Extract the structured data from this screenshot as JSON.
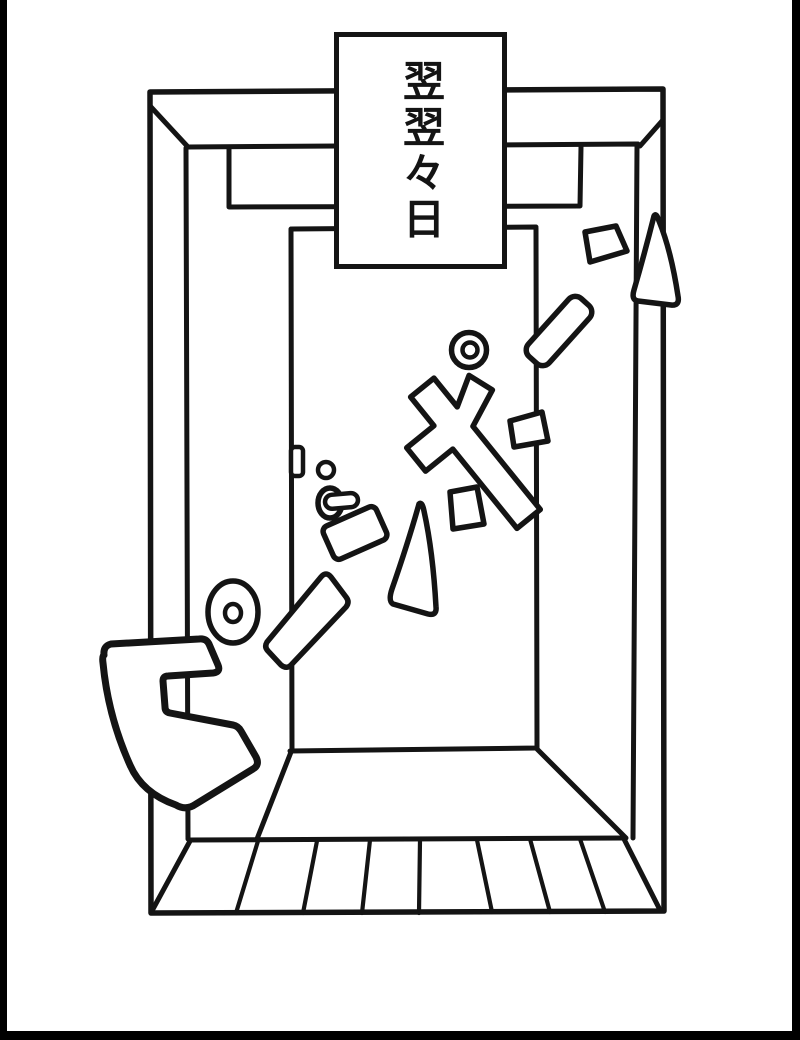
{
  "colors": {
    "ink": "#141414",
    "paper": "#ffffff",
    "panel_border": "#000000"
  },
  "caption": {
    "text": "翌翌々日"
  },
  "scene": {
    "kind": "manga-panel-drawing",
    "subject": "front-door-entryway-in-perspective",
    "sound_effect": {
      "visible_glyphs": [
        "ピ",
        "ポ"
      ],
      "style": "katakana-pieces-breaking-apart"
    }
  }
}
